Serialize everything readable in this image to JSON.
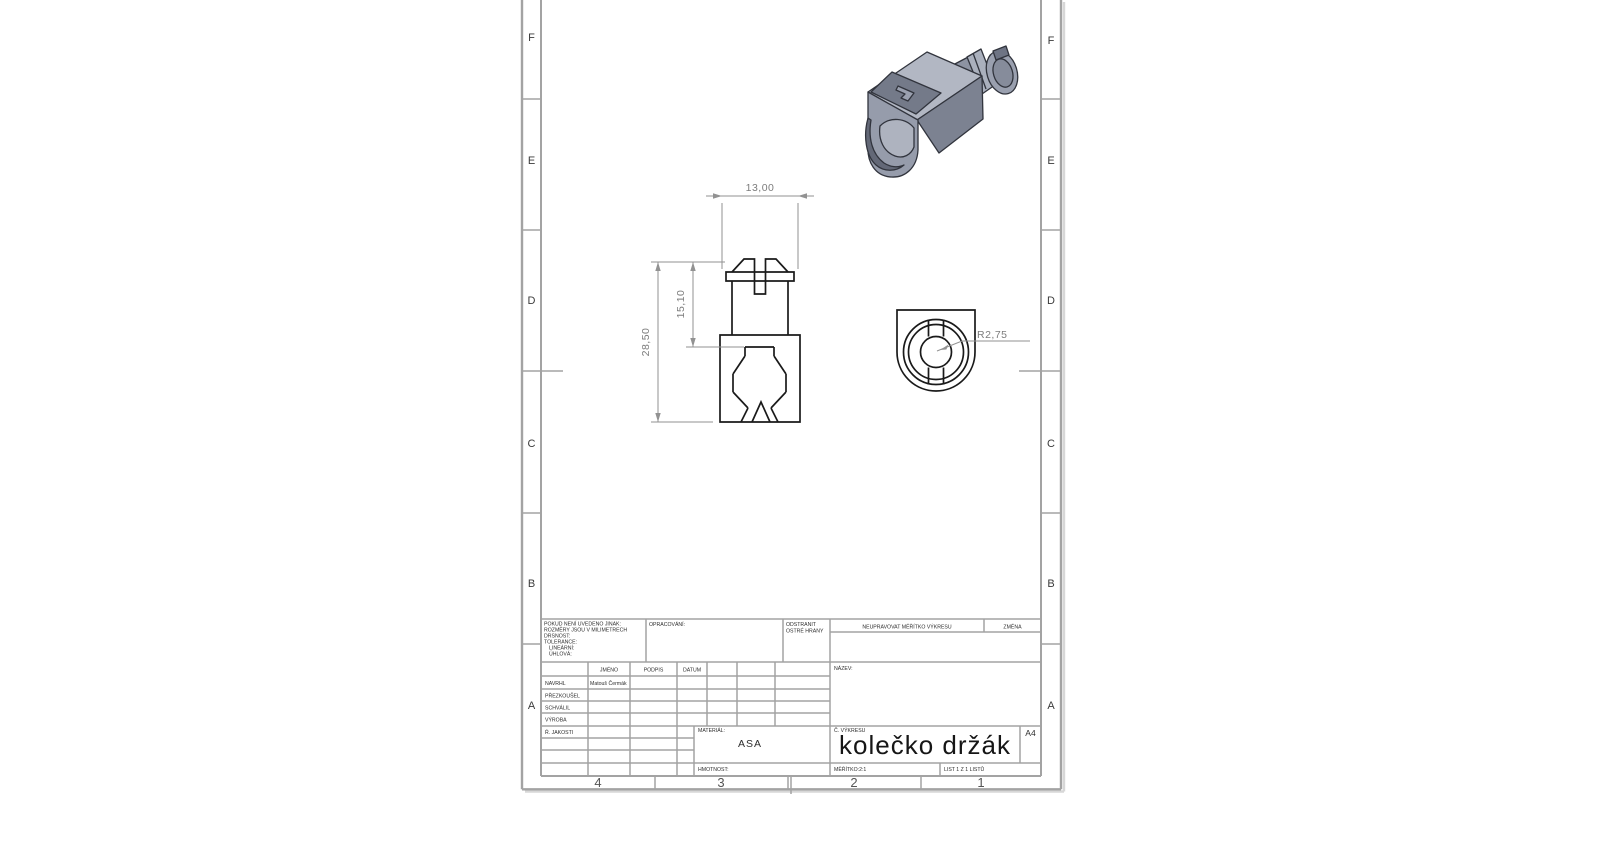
{
  "app": {
    "type": "cad-drawing-sheet",
    "standard": "A4 portrait, Czech SolidWorks template"
  },
  "colors": {
    "paper": "#ffffff",
    "frame_gray": "#a3a3a3",
    "drawing_line": "#1a1a1a",
    "dimension_gray": "#929292",
    "dimension_text_gray": "#7c7c7c",
    "part_fill_light": "#b2b7c3",
    "part_fill_mid": "#969cab",
    "part_fill_dark": "#747a89"
  },
  "zones": {
    "left": [
      "F",
      "E",
      "D",
      "C",
      "B",
      "A"
    ],
    "right": [
      "F",
      "E",
      "D",
      "C",
      "B",
      "A"
    ],
    "bottom": [
      "4",
      "3",
      "2",
      "1"
    ]
  },
  "views": {
    "front": {
      "dim_width": "13,00",
      "dim_height_total": "28,50",
      "dim_height_upper": "15,10"
    },
    "section": {
      "dim_radius": "R2,75"
    }
  },
  "title_block": {
    "general_note": {
      "line1": "POKUD NENÍ UVEDENO JINAK:",
      "line2": "ROZMĚRY JSOU V MILIMETRECH",
      "line3": "DRSNOST:",
      "line4": "TOLERANCE:",
      "line5": "LINEÁRNÍ:",
      "line6": "ÚHLOVÁ:"
    },
    "machining_label": "OPRACOVÁNÍ:",
    "deburr_line1": "ODSTRANIT",
    "deburr_line2": "OSTRÉ HRANY",
    "do_not_scale_note": "NEUPRAVOVAT MĚŘÍTKO VÝKRESU",
    "revision_label": "ZMĚNA",
    "col_name": "JMÉNO",
    "col_signature": "PODPIS",
    "col_date": "DATUM",
    "row_drawn": "NAVRHL",
    "row_checked": "PŘEZKOUŠEL",
    "row_approved": "SCHVÁLIL",
    "row_production": "VÝROBA",
    "row_quality": "Ř. JAKOSTI",
    "drawn_by_name": "Matouš Čermák",
    "title_label": "NÁZEV:",
    "material_label": "MATERIÁL:",
    "material_value": "ASA",
    "drawing_no_label": "Č. VÝKRESU",
    "drawing_title": "kolečko držák",
    "paper_size": "A4",
    "weight_label": "HMOTNOST:",
    "scale_text": "MĚŘÍTKO:2:1",
    "sheet_text": "LIST 1 Z 1 LISTŮ"
  }
}
